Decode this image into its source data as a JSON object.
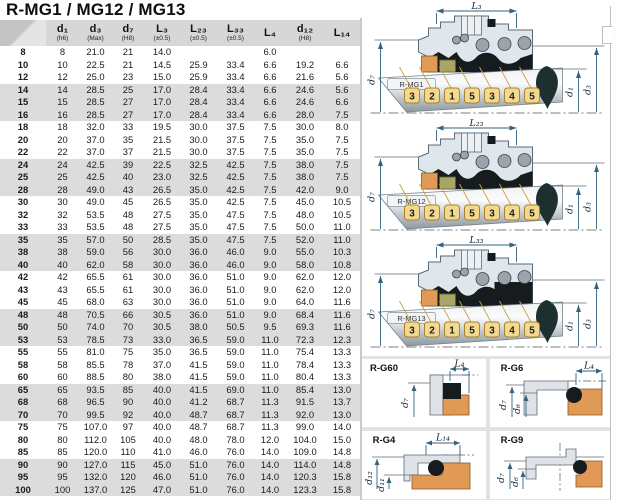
{
  "title": "R-MG1 / MG12 / MG13",
  "colors": {
    "header_bg": "#d7d7d7",
    "row_band": "#dcdcdc",
    "panel_bg": "#e3e3e3",
    "dim_line": "#34627f",
    "orange_part": "#e09a55",
    "olive_part": "#a9a565",
    "number_box": "#f2d98e",
    "dark_part": "#161c1e"
  },
  "table": {
    "columns": [
      {
        "label": "",
        "sub": ""
      },
      {
        "label": "d₁",
        "sub": "(h6)"
      },
      {
        "label": "d₃",
        "sub": "(Max)"
      },
      {
        "label": "d₇",
        "sub": "(H8)"
      },
      {
        "label": "L₃",
        "sub": "(±0.5)"
      },
      {
        "label": "L₂₃",
        "sub": "(±0.5)"
      },
      {
        "label": "L₃₃",
        "sub": "(±0.5)"
      },
      {
        "label": "L₄",
        "sub": ""
      },
      {
        "label": "d₁₂",
        "sub": "(H8)"
      },
      {
        "label": "L₁₄",
        "sub": ""
      }
    ],
    "rows": [
      [
        "8",
        "8",
        "21.0",
        "21",
        "14.0",
        "",
        "",
        "6.0",
        "",
        ""
      ],
      [
        "10",
        "10",
        "22.5",
        "21",
        "14.5",
        "25.9",
        "33.4",
        "6.6",
        "19.2",
        "6.6"
      ],
      [
        "12",
        "12",
        "25.0",
        "23",
        "15.0",
        "25.9",
        "33.4",
        "6.6",
        "21.6",
        "5.6"
      ],
      [
        "14",
        "14",
        "28.5",
        "25",
        "17.0",
        "28.4",
        "33.4",
        "6.6",
        "24.6",
        "5.6"
      ],
      [
        "15",
        "15",
        "28.5",
        "27",
        "17.0",
        "28.4",
        "33.4",
        "6.6",
        "24.6",
        "6.6"
      ],
      [
        "16",
        "16",
        "28.5",
        "27",
        "17.0",
        "28.4",
        "33.4",
        "6.6",
        "28.0",
        "7.5"
      ],
      [
        "18",
        "18",
        "32.0",
        "33",
        "19.5",
        "30.0",
        "37.5",
        "7.5",
        "30.0",
        "8.0"
      ],
      [
        "20",
        "20",
        "37.0",
        "35",
        "21.5",
        "30.0",
        "37.5",
        "7.5",
        "35.0",
        "7.5"
      ],
      [
        "22",
        "22",
        "37.0",
        "37",
        "21.5",
        "30.0",
        "37.5",
        "7.5",
        "35.0",
        "7.5"
      ],
      [
        "24",
        "24",
        "42.5",
        "39",
        "22.5",
        "32.5",
        "42.5",
        "7.5",
        "38.0",
        "7.5"
      ],
      [
        "25",
        "25",
        "42.5",
        "40",
        "23.0",
        "32.5",
        "42.5",
        "7.5",
        "38.0",
        "7.5"
      ],
      [
        "28",
        "28",
        "49.0",
        "43",
        "26.5",
        "35.0",
        "42.5",
        "7.5",
        "42.0",
        "9.0"
      ],
      [
        "30",
        "30",
        "49.0",
        "45",
        "26.5",
        "35.0",
        "42.5",
        "7.5",
        "45.0",
        "10.5"
      ],
      [
        "32",
        "32",
        "53.5",
        "48",
        "27.5",
        "35.0",
        "47.5",
        "7.5",
        "48.0",
        "10.5"
      ],
      [
        "33",
        "33",
        "53.5",
        "48",
        "27.5",
        "35.0",
        "47.5",
        "7.5",
        "50.0",
        "11.0"
      ],
      [
        "35",
        "35",
        "57.0",
        "50",
        "28.5",
        "35.0",
        "47.5",
        "7.5",
        "52.0",
        "11.0"
      ],
      [
        "38",
        "38",
        "59.0",
        "56",
        "30.0",
        "36.0",
        "46.0",
        "9.0",
        "55.0",
        "10.3"
      ],
      [
        "40",
        "40",
        "62.0",
        "58",
        "30.0",
        "36.0",
        "46.0",
        "9.0",
        "58.0",
        "10.8"
      ],
      [
        "42",
        "42",
        "65.5",
        "61",
        "30.0",
        "36.0",
        "51.0",
        "9.0",
        "62.0",
        "12.0"
      ],
      [
        "43",
        "43",
        "65.5",
        "61",
        "30.0",
        "36.0",
        "51.0",
        "9.0",
        "62.0",
        "12.0"
      ],
      [
        "45",
        "45",
        "68.0",
        "63",
        "30.0",
        "36.0",
        "51.0",
        "9.0",
        "64.0",
        "11.6"
      ],
      [
        "48",
        "48",
        "70.5",
        "66",
        "30.5",
        "36.0",
        "51.0",
        "9.0",
        "68.4",
        "11.6"
      ],
      [
        "50",
        "50",
        "74.0",
        "70",
        "30.5",
        "38.0",
        "50.5",
        "9.5",
        "69.3",
        "11.6"
      ],
      [
        "53",
        "53",
        "78.5",
        "73",
        "33.0",
        "36.5",
        "59.0",
        "11.0",
        "72.3",
        "12.3"
      ],
      [
        "55",
        "55",
        "81.0",
        "75",
        "35.0",
        "36.5",
        "59.0",
        "11.0",
        "75.4",
        "13.3"
      ],
      [
        "58",
        "58",
        "85.5",
        "78",
        "37.0",
        "41.5",
        "59.0",
        "11.0",
        "78.4",
        "13.3"
      ],
      [
        "60",
        "60",
        "88.5",
        "80",
        "38.0",
        "41.5",
        "59.0",
        "11.0",
        "80.4",
        "13.3"
      ],
      [
        "65",
        "65",
        "93.5",
        "85",
        "40.0",
        "41.5",
        "69.0",
        "11.0",
        "85.4",
        "13.0"
      ],
      [
        "68",
        "68",
        "96.5",
        "90",
        "40.0",
        "41.2",
        "68.7",
        "11.3",
        "91.5",
        "13.7"
      ],
      [
        "70",
        "70",
        "99.5",
        "92",
        "40.0",
        "48.7",
        "68.7",
        "11.3",
        "92.0",
        "13.0"
      ],
      [
        "75",
        "75",
        "107.0",
        "97",
        "40.0",
        "48.7",
        "68.7",
        "11.3",
        "99.0",
        "14.0"
      ],
      [
        "80",
        "80",
        "112.0",
        "105",
        "40.0",
        "48.0",
        "78.0",
        "12.0",
        "104.0",
        "15.0"
      ],
      [
        "85",
        "85",
        "120.0",
        "110",
        "41.0",
        "46.0",
        "76.0",
        "14.0",
        "109.0",
        "14.8"
      ],
      [
        "90",
        "90",
        "127.0",
        "115",
        "45.0",
        "51.0",
        "76.0",
        "14.0",
        "114.0",
        "14.8"
      ],
      [
        "95",
        "95",
        "132.0",
        "120",
        "46.0",
        "51.0",
        "76.0",
        "14.0",
        "120.3",
        "15.8"
      ],
      [
        "100",
        "100",
        "137.0",
        "125",
        "47.0",
        "51.0",
        "76.0",
        "14.0",
        "123.3",
        "15.8"
      ]
    ]
  },
  "diagrams": {
    "mg1": {
      "name": "R-MG1",
      "dim_top": "L₃",
      "dim_left": "d₇",
      "dim_inner_right": "d₁",
      "dim_outer_right": "d₃",
      "part_numbers": [
        "3",
        "2",
        "1",
        "5",
        "3",
        "4",
        "5"
      ]
    },
    "mg12": {
      "name": "R-MG12",
      "dim_top": "L₂₃",
      "dim_left": "d₇",
      "dim_inner_right": "d₁",
      "dim_outer_right": "d₃",
      "part_numbers": [
        "3",
        "2",
        "1",
        "5",
        "3",
        "4",
        "5"
      ]
    },
    "mg13": {
      "name": "R-MG13",
      "dim_top": "L₃₃",
      "dim_left": "d₇",
      "dim_inner_right": "d₁",
      "dim_outer_right": "d₃",
      "part_numbers": [
        "3",
        "2",
        "1",
        "5",
        "3",
        "4",
        "5"
      ]
    },
    "g60": {
      "name": "R-G60",
      "dim_top": "L₄",
      "dim_left_outer": "d₇"
    },
    "g6": {
      "name": "R-G6",
      "dim_top": "L₄",
      "dim_left_outer": "d₇",
      "dim_left_inner": "d₆"
    },
    "g4": {
      "name": "R-G4",
      "dim_top": "L₁₄",
      "dim_left_outer": "d₁₂",
      "dim_left_inner": "d₁₁"
    },
    "g9": {
      "name": "R-G9",
      "dim_left_outer": "d₇",
      "dim_left_inner": "d₆"
    }
  }
}
